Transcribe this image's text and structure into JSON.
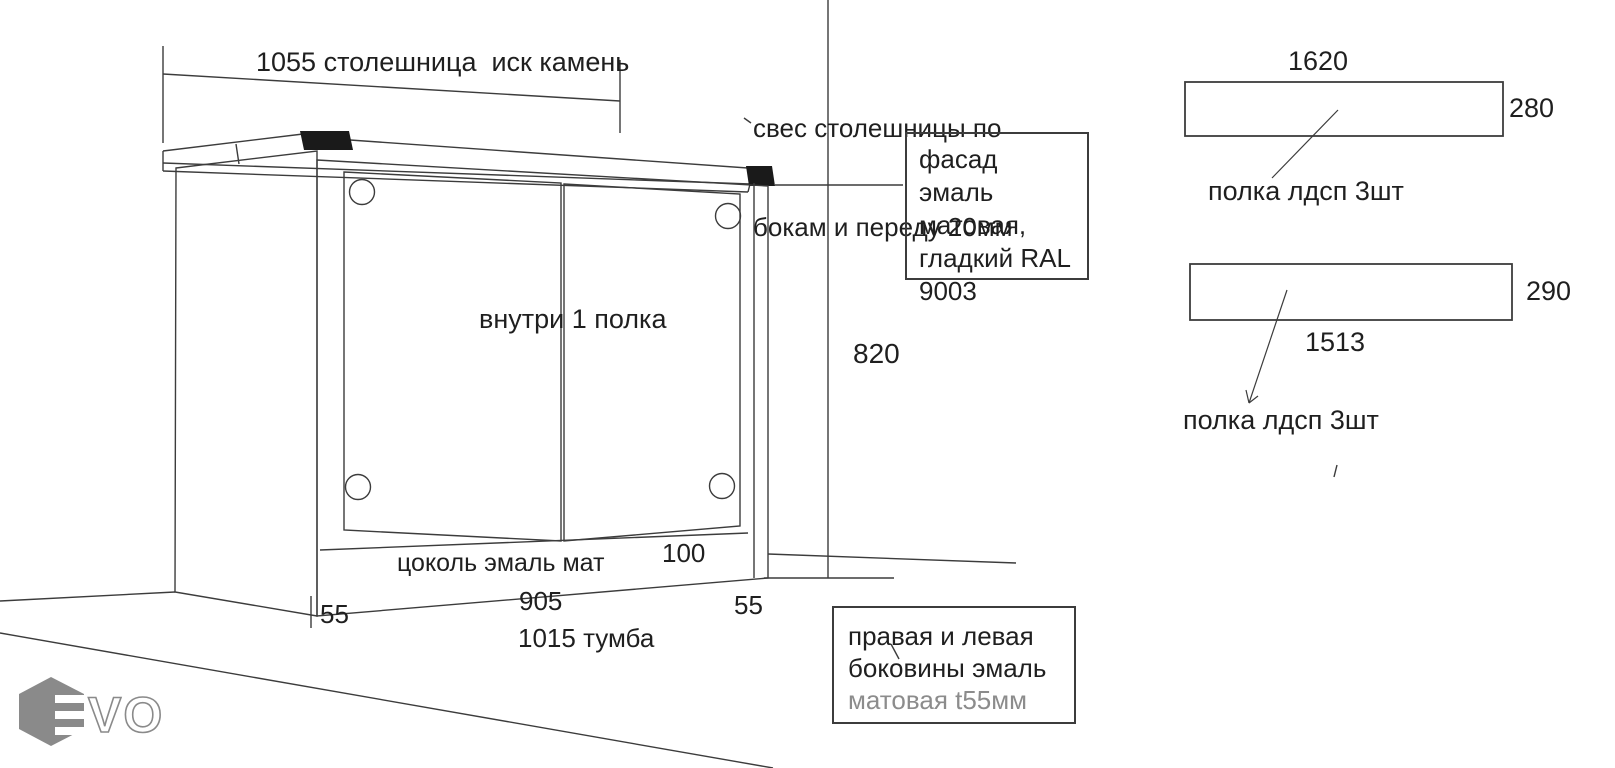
{
  "colors": {
    "line": "#3c3c3c",
    "text": "#1f1f1f",
    "gray_text": "#8c8c8c",
    "logo_gray": "#8a8a8a",
    "corner_cap": "#1a1a1a",
    "background": "#ffffff"
  },
  "cabinet": {
    "countertop_dim": "1055 столешница  иск камень",
    "overhang_note_line1": "свес столешницы по",
    "overhang_note_line2": "бокам и переду 20мм",
    "inside_label": "внутри 1 полка",
    "height_dim": "820",
    "plinth_label": "цоколь эмаль мат",
    "plinth_height": "100",
    "left_side_thickness": "55",
    "body_width": "905",
    "right_side_thickness": "55",
    "total_width_label": "1015 тумба"
  },
  "facade_note": {
    "line1": "фасад эмаль",
    "line2": "матовая,",
    "line3": "гладкий RAL",
    "line4": "9003"
  },
  "sides_note": {
    "line1": "правая и левая",
    "line2": "боковины эмаль",
    "line3": "матовая t55мм"
  },
  "shelf1": {
    "width": "1620",
    "depth": "280",
    "label": "полка лдсп 3шт"
  },
  "shelf2": {
    "depth": "290",
    "width": "1513",
    "label": "полка лдсп 3шт"
  },
  "logo": {
    "letters": "VO"
  }
}
